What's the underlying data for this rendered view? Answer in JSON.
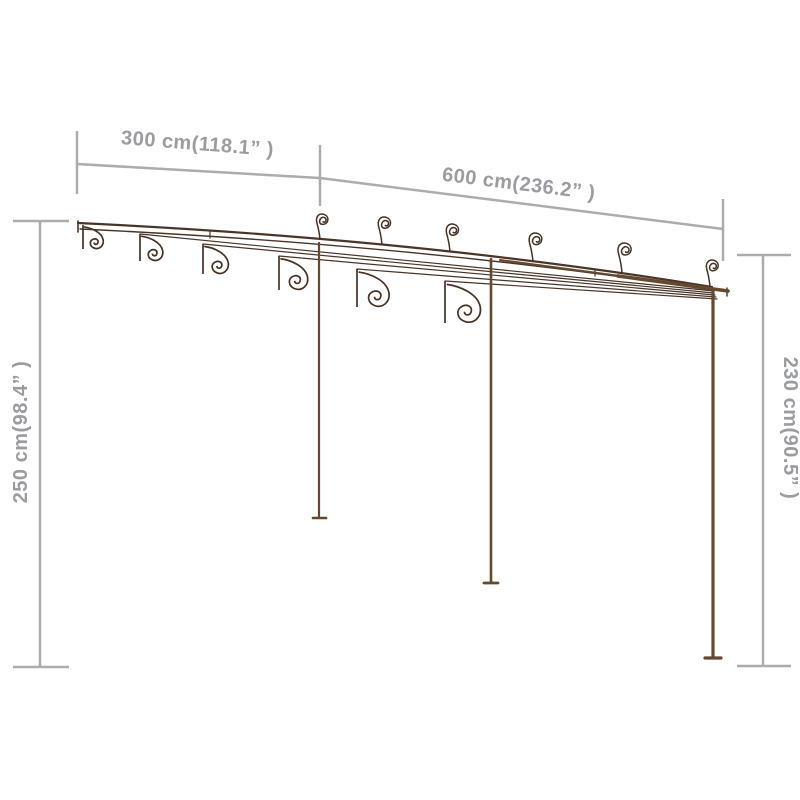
{
  "figure": {
    "kind": "product-dimension-diagram",
    "subject": "garden-pergola-wireframe",
    "background": "#ffffff"
  },
  "dimensions": {
    "top_left": {
      "label": "300 cm(118.1” )",
      "value_cm": 300,
      "value_in": 118.1
    },
    "top_right": {
      "label": "600 cm(236.2” )",
      "value_cm": 600,
      "value_in": 236.2
    },
    "left": {
      "label": "250 cm(98.4” )",
      "value_cm": 250,
      "value_in": 98.4
    },
    "right": {
      "label": "230 cm(90.5” )",
      "value_cm": 230,
      "value_in": 90.5
    }
  },
  "colors": {
    "dimension_line": "#abadac",
    "dimension_text": "#9a9c9f",
    "frame_dark": "#4a3528",
    "frame_mid": "#65492f",
    "frame_scroll": "#463225"
  }
}
